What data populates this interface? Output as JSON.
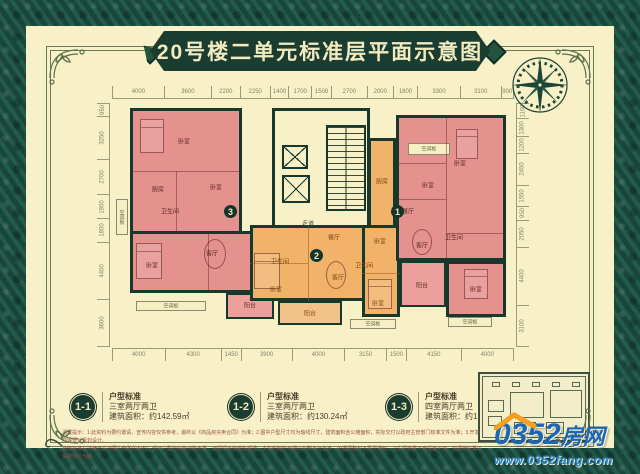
{
  "title": "20号楼二单元标准层平面示意图",
  "dimensions": {
    "top": [
      4000,
      3600,
      2200,
      2250,
      1400,
      1700,
      1500,
      2700,
      2000,
      1800,
      3300,
      3100,
      900
    ],
    "bottom": [
      4000,
      4300,
      1450,
      3900,
      4000,
      3150,
      1500,
      4150,
      4000
    ],
    "left": [
      950,
      3250,
      2700,
      1800,
      1800,
      4400,
      3600
    ],
    "right": [
      1100,
      1300,
      1200,
      2450,
      1550,
      950,
      2050,
      4400,
      3100
    ]
  },
  "plan": {
    "badges": [
      {
        "num": "3",
        "x": 112,
        "y": 102
      },
      {
        "num": "2",
        "x": 198,
        "y": 146
      },
      {
        "num": "1",
        "x": 279,
        "y": 102
      }
    ],
    "rooms": [
      {
        "label": "卧室",
        "x": 72,
        "y": 38,
        "cls": "p"
      },
      {
        "label": "卧室",
        "x": 104,
        "y": 84,
        "cls": "p"
      },
      {
        "label": "厨房",
        "x": 46,
        "y": 86,
        "cls": "p"
      },
      {
        "label": "卫生间",
        "x": 58,
        "y": 108,
        "cls": "p"
      },
      {
        "label": "客厅",
        "x": 100,
        "y": 150,
        "cls": "p"
      },
      {
        "label": "卧室",
        "x": 40,
        "y": 162,
        "cls": "p"
      },
      {
        "label": "阳台",
        "x": 138,
        "y": 202,
        "cls": "p"
      },
      {
        "label": "空调板",
        "x": 59,
        "y": 203,
        "cls": "ac"
      },
      {
        "label": "空调板",
        "x": 10,
        "y": 114,
        "cls": "acv"
      },
      {
        "label": "走道",
        "x": 196,
        "y": 120,
        "cls": "c"
      },
      {
        "label": "厨房",
        "x": 270,
        "y": 78,
        "cls": "o"
      },
      {
        "label": "餐厅",
        "x": 222,
        "y": 134,
        "cls": "o"
      },
      {
        "label": "卧室",
        "x": 268,
        "y": 138,
        "cls": "o"
      },
      {
        "label": "卫生间",
        "x": 168,
        "y": 158,
        "cls": "o"
      },
      {
        "label": "卫生间",
        "x": 252,
        "y": 162,
        "cls": "o"
      },
      {
        "label": "客厅",
        "x": 226,
        "y": 174,
        "cls": "o"
      },
      {
        "label": "卧室",
        "x": 164,
        "y": 186,
        "cls": "o"
      },
      {
        "label": "卧室",
        "x": 266,
        "y": 200,
        "cls": "o"
      },
      {
        "label": "阳台",
        "x": 198,
        "y": 210,
        "cls": "o"
      },
      {
        "label": "空调板",
        "x": 261,
        "y": 221,
        "cls": "ac"
      },
      {
        "label": "空调板",
        "x": 317,
        "y": 46,
        "cls": "ac"
      },
      {
        "label": "卧室",
        "x": 348,
        "y": 60,
        "cls": "p"
      },
      {
        "label": "卧室",
        "x": 316,
        "y": 82,
        "cls": "p"
      },
      {
        "label": "餐厅",
        "x": 296,
        "y": 108,
        "cls": "p"
      },
      {
        "label": "卫生间",
        "x": 342,
        "y": 134,
        "cls": "p"
      },
      {
        "label": "客厅",
        "x": 310,
        "y": 142,
        "cls": "p"
      },
      {
        "label": "阳台",
        "x": 310,
        "y": 182,
        "cls": "p"
      },
      {
        "label": "卧室",
        "x": 364,
        "y": 186,
        "cls": "p"
      },
      {
        "label": "空调板",
        "x": 358,
        "y": 219,
        "cls": "ac"
      }
    ]
  },
  "legend": [
    {
      "badge": "1-1",
      "type": "户型标准",
      "layout": "三室两厅两卫",
      "area": "建筑面积：约142.59㎡"
    },
    {
      "badge": "1-2",
      "type": "户型标准",
      "layout": "三室两厅两卫",
      "area": "建筑面积：约130.24㎡"
    },
    {
      "badge": "1-3",
      "type": "户型标准",
      "layout": "四室两厅两卫",
      "area": "建筑面积：约167.77㎡"
    }
  ],
  "disclaimer": {
    "line1": "温馨提示：1.此资料为要约邀请，宣传内容仅供参考，最终以《商品房买卖合同》为准；2.图中户型尺寸均为轴线尺寸，建筑面积含公摊面积，实际交付以政府主管部门核准文件为准；3.开发商保留对规划设计、",
    "line2": "装修标准在法律允许范围内修改的权利；部分户型为镜像对称布置，详情请咨询销售现场；本资料制作日期以印刷当日为准，如遇调整恕不另行通知。卫生间数量不含设备平台，空调板位置以实际交付为准。"
  },
  "watermark": {
    "brand_prefix": "0352",
    "brand_suffix": "房网",
    "site": "www.0352fang.com"
  },
  "colors": {
    "border_green": "#1d5143",
    "banner_green": "#1b3d31",
    "cream": "#f8f1c8",
    "unit_pink": "#e5928e",
    "unit_orange": "#f0b369",
    "wall": "#17382d",
    "logo_blue": "#1b67b0",
    "roof_orange": "#f59f1e"
  }
}
